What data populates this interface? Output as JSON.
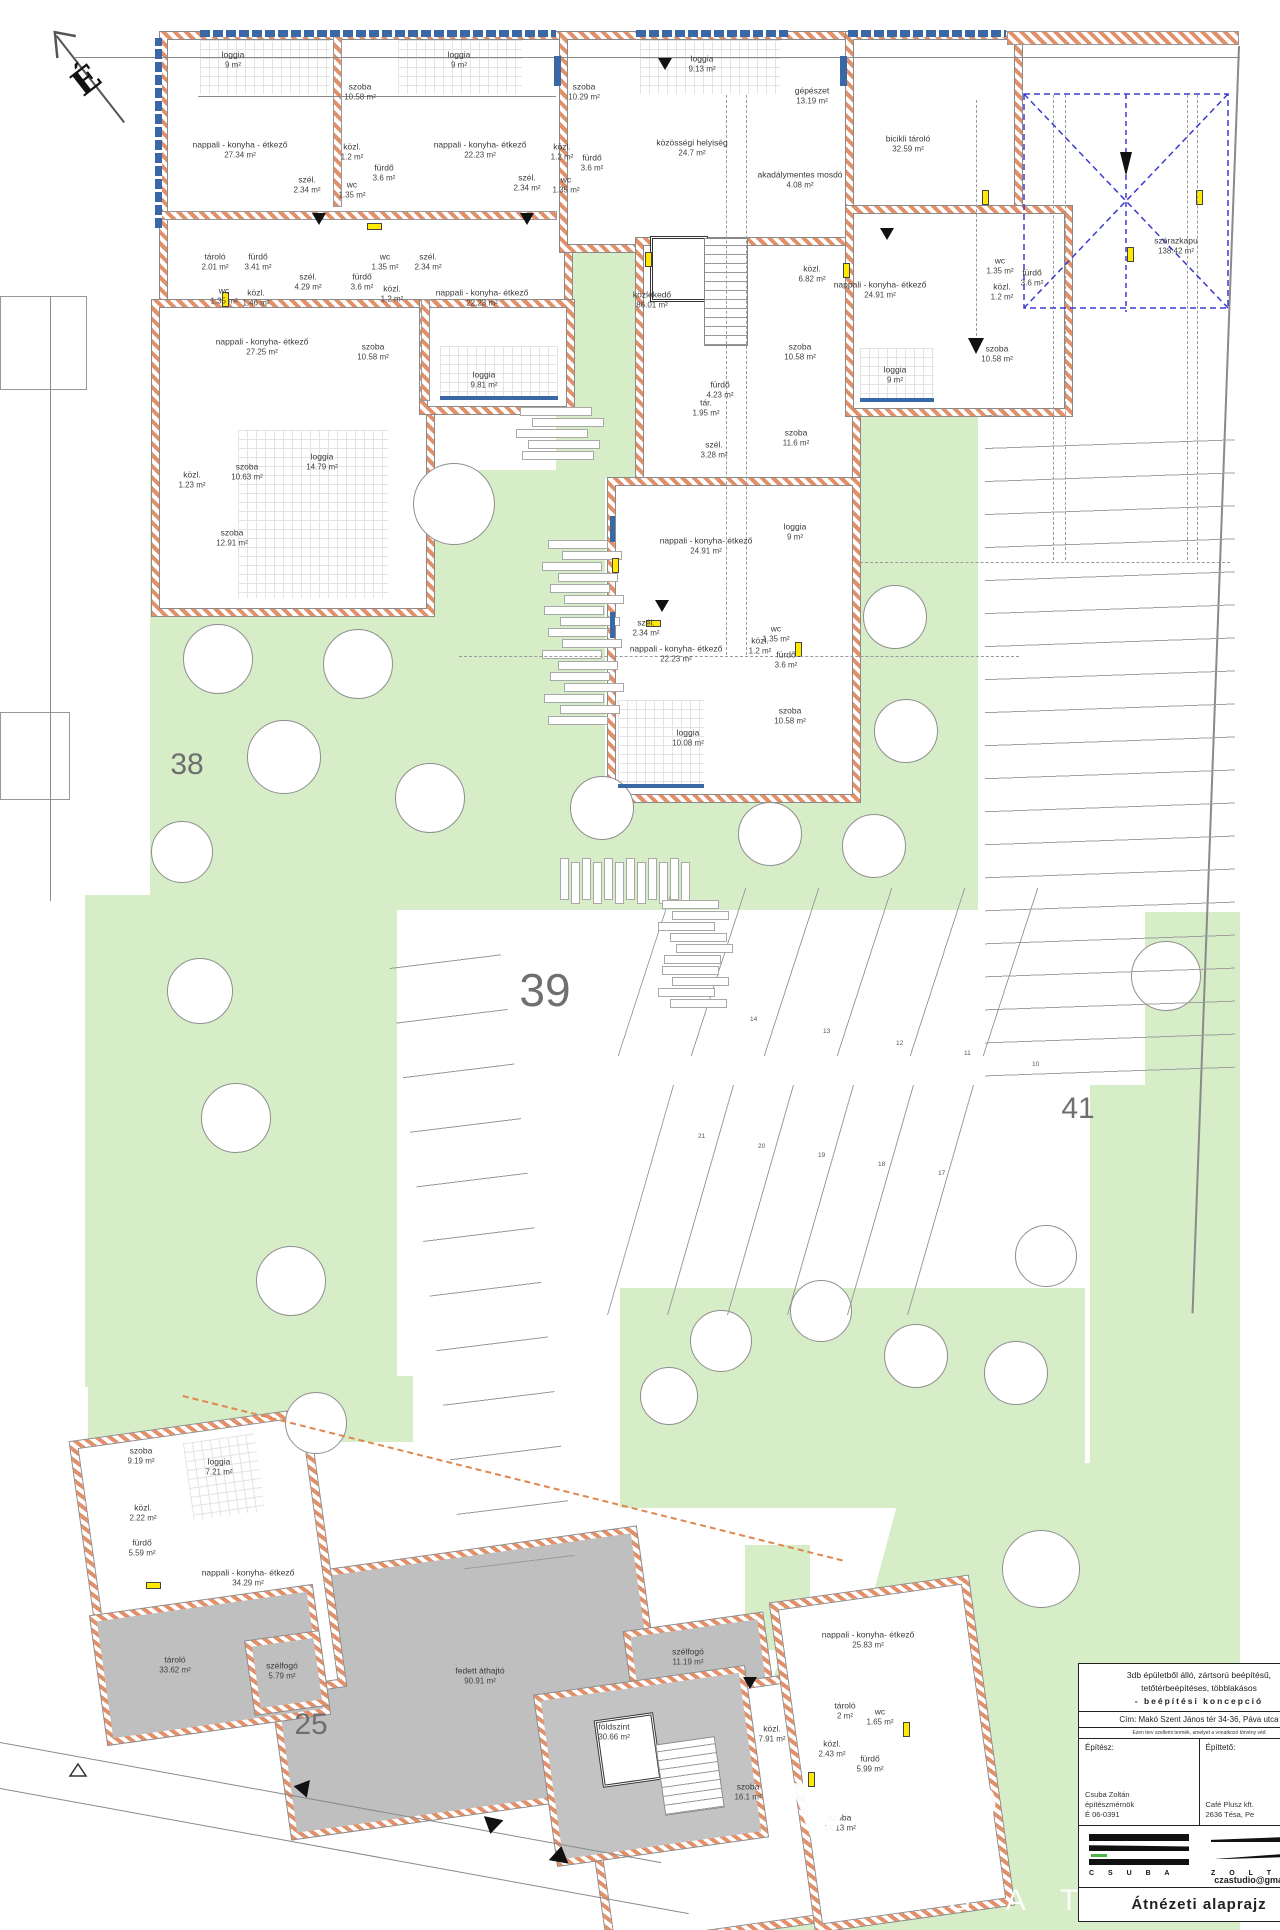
{
  "meta": {
    "compass_letter": "É",
    "sheet_type": "floor plan"
  },
  "watermark": {
    "big": "VÁR",
    "small": "I N G A T"
  },
  "plot_numbers": [
    {
      "t": "38",
      "x": 187,
      "y": 765,
      "s": 30
    },
    {
      "t": "39",
      "x": 545,
      "y": 990,
      "s": 46
    },
    {
      "t": "41",
      "x": 1078,
      "y": 1109,
      "s": 30
    },
    {
      "t": "25",
      "x": 311,
      "y": 1725,
      "s": 30
    }
  ],
  "parking_numbers": [
    {
      "t": "14",
      "x": 750,
      "y": 1016
    },
    {
      "t": "13",
      "x": 823,
      "y": 1028
    },
    {
      "t": "12",
      "x": 896,
      "y": 1040
    },
    {
      "t": "11",
      "x": 964,
      "y": 1050
    },
    {
      "t": "10",
      "x": 1032,
      "y": 1061
    },
    {
      "t": "21",
      "x": 698,
      "y": 1133
    },
    {
      "t": "20",
      "x": 758,
      "y": 1143
    },
    {
      "t": "19",
      "x": 818,
      "y": 1152
    },
    {
      "t": "18",
      "x": 878,
      "y": 1161
    },
    {
      "t": "17",
      "x": 938,
      "y": 1170
    }
  ],
  "rooms": [
    {
      "n": "loggia",
      "a": "9 m²",
      "x": 233,
      "y": 60
    },
    {
      "n": "szoba",
      "a": "10.58 m²",
      "x": 360,
      "y": 92
    },
    {
      "n": "loggia",
      "a": "9 m²",
      "x": 459,
      "y": 60
    },
    {
      "n": "nappali - konyha - étkező",
      "a": "27.34 m²",
      "x": 240,
      "y": 150
    },
    {
      "n": "közl.",
      "a": "1.2 m²",
      "x": 352,
      "y": 152
    },
    {
      "n": "fürdő",
      "a": "3.6 m²",
      "x": 384,
      "y": 173
    },
    {
      "n": "szél.",
      "a": "2.34 m²",
      "x": 307,
      "y": 185
    },
    {
      "n": "wc",
      "a": "1.35 m²",
      "x": 352,
      "y": 190
    },
    {
      "n": "nappali - konyha- étkező",
      "a": "22.23 m²",
      "x": 480,
      "y": 150
    },
    {
      "n": "szél.",
      "a": "2.34 m²",
      "x": 527,
      "y": 183
    },
    {
      "n": "szoba",
      "a": "10.29 m²",
      "x": 584,
      "y": 92
    },
    {
      "n": "közl.",
      "a": "1.2 m²",
      "x": 562,
      "y": 152
    },
    {
      "n": "fürdő",
      "a": "3.6 m²",
      "x": 592,
      "y": 163
    },
    {
      "n": "wc",
      "a": "1.35 m²",
      "x": 566,
      "y": 185
    },
    {
      "n": "tároló",
      "a": "2.01 m²",
      "x": 215,
      "y": 262
    },
    {
      "n": "fürdő",
      "a": "3.41 m²",
      "x": 258,
      "y": 262
    },
    {
      "n": "szél.",
      "a": "4.29 m²",
      "x": 308,
      "y": 282
    },
    {
      "n": "wc",
      "a": "1.35 m²",
      "x": 224,
      "y": 296
    },
    {
      "n": "közl.",
      "a": "1.46 m²",
      "x": 256,
      "y": 298
    },
    {
      "n": "nappali - konyha- étkező",
      "a": "27.25 m²",
      "x": 262,
      "y": 347
    },
    {
      "n": "fürdő",
      "a": "3.6 m²",
      "x": 362,
      "y": 282
    },
    {
      "n": "wc",
      "a": "1.35 m²",
      "x": 385,
      "y": 262
    },
    {
      "n": "közl.",
      "a": "1.2 m²",
      "x": 392,
      "y": 294
    },
    {
      "n": "szél.",
      "a": "2.34 m²",
      "x": 428,
      "y": 262
    },
    {
      "n": "szoba",
      "a": "10.58 m²",
      "x": 373,
      "y": 352
    },
    {
      "n": "nappali - konyha- étkező",
      "a": "22.23 m²",
      "x": 482,
      "y": 298
    },
    {
      "n": "loggia",
      "a": "9.81 m²",
      "x": 484,
      "y": 380
    },
    {
      "n": "szoba",
      "a": "10.63 m²",
      "x": 247,
      "y": 472
    },
    {
      "n": "közl.",
      "a": "1.23 m²",
      "x": 192,
      "y": 480
    },
    {
      "n": "loggia",
      "a": "14.79 m²",
      "x": 322,
      "y": 462
    },
    {
      "n": "szoba",
      "a": "12.91 m²",
      "x": 232,
      "y": 538
    },
    {
      "n": "loggia",
      "a": "9.13 m²",
      "x": 702,
      "y": 64
    },
    {
      "n": "közösségi helyiség",
      "a": "24.7 m²",
      "x": 692,
      "y": 148
    },
    {
      "n": "gépészet",
      "a": "13.19 m²",
      "x": 812,
      "y": 96
    },
    {
      "n": "akadálymentes mosdó",
      "a": "4.08 m²",
      "x": 800,
      "y": 180
    },
    {
      "n": "közlekedő",
      "a": "86.01 m²",
      "x": 652,
      "y": 300
    },
    {
      "n": "közl.",
      "a": "6.82 m²",
      "x": 812,
      "y": 274
    },
    {
      "n": "fürdő",
      "a": "4.23 m²",
      "x": 720,
      "y": 390
    },
    {
      "n": "tár.",
      "a": "1.95 m²",
      "x": 706,
      "y": 408
    },
    {
      "n": "szél.",
      "a": "3.28 m²",
      "x": 714,
      "y": 450
    },
    {
      "n": "szoba",
      "a": "11.6 m²",
      "x": 796,
      "y": 438
    },
    {
      "n": "szoba",
      "a": "10.58 m²",
      "x": 800,
      "y": 352
    },
    {
      "n": "nappali - konyha- étkező",
      "a": "24.91 m²",
      "x": 880,
      "y": 290
    },
    {
      "n": "loggia",
      "a": "9 m²",
      "x": 895,
      "y": 375
    },
    {
      "n": "nappali - konyha- étkező",
      "a": "24.91 m²",
      "x": 706,
      "y": 546
    },
    {
      "n": "loggia",
      "a": "9 m²",
      "x": 795,
      "y": 532
    },
    {
      "n": "szél.",
      "a": "2.34 m²",
      "x": 646,
      "y": 628
    },
    {
      "n": "nappali - konyha- étkező",
      "a": "22.23 m²",
      "x": 676,
      "y": 654
    },
    {
      "n": "wc",
      "a": "1.35 m²",
      "x": 776,
      "y": 634
    },
    {
      "n": "közl.",
      "a": "1.2 m²",
      "x": 760,
      "y": 646
    },
    {
      "n": "fürdő",
      "a": "3.6 m²",
      "x": 786,
      "y": 660
    },
    {
      "n": "szoba",
      "a": "10.58 m²",
      "x": 790,
      "y": 716
    },
    {
      "n": "loggia",
      "a": "10.08 m²",
      "x": 688,
      "y": 738
    },
    {
      "n": "bicikli tároló",
      "a": "32.59 m²",
      "x": 908,
      "y": 144
    },
    {
      "n": "szárazkapu",
      "a": "138.42 m²",
      "x": 1176,
      "y": 246
    },
    {
      "n": "wc",
      "a": "1.35 m²",
      "x": 1000,
      "y": 266
    },
    {
      "n": "fürdő",
      "a": "3.6 m²",
      "x": 1032,
      "y": 278
    },
    {
      "n": "közl.",
      "a": "1.2 m²",
      "x": 1002,
      "y": 292
    },
    {
      "n": "szoba",
      "a": "10.58 m²",
      "x": 997,
      "y": 354
    },
    {
      "n": "szoba",
      "a": "9.19 m²",
      "x": 141,
      "y": 1456
    },
    {
      "n": "loggia",
      "a": "7.21 m²",
      "x": 219,
      "y": 1467
    },
    {
      "n": "közl.",
      "a": "2.22 m²",
      "x": 143,
      "y": 1513
    },
    {
      "n": "fürdő",
      "a": "5.59 m²",
      "x": 142,
      "y": 1548
    },
    {
      "n": "nappali - konyha- étkező",
      "a": "34.29 m²",
      "x": 248,
      "y": 1578
    },
    {
      "n": "tároló",
      "a": "33.62 m²",
      "x": 175,
      "y": 1665
    },
    {
      "n": "szélfogó",
      "a": "5.79 m²",
      "x": 282,
      "y": 1671
    },
    {
      "n": "fedett áthajtó",
      "a": "90.91 m²",
      "x": 480,
      "y": 1676
    },
    {
      "n": "szélfogó",
      "a": "11.19 m²",
      "x": 688,
      "y": 1657
    },
    {
      "n": "földszint",
      "a": "30.66 m²",
      "x": 614,
      "y": 1732
    },
    {
      "n": "közl.",
      "a": "7.91 m²",
      "x": 772,
      "y": 1734
    },
    {
      "n": "szoba",
      "a": "16.1 m²",
      "x": 748,
      "y": 1792
    },
    {
      "n": "nappali - konyha- étkező",
      "a": "25.83 m²",
      "x": 868,
      "y": 1640
    },
    {
      "n": "tároló",
      "a": "2 m²",
      "x": 845,
      "y": 1711
    },
    {
      "n": "wc",
      "a": "1.65 m²",
      "x": 880,
      "y": 1717
    },
    {
      "n": "közl.",
      "a": "2.43 m²",
      "x": 832,
      "y": 1749
    },
    {
      "n": "fürdő",
      "a": "5.99 m²",
      "x": 870,
      "y": 1764
    },
    {
      "n": "szoba",
      "a": "14.13 m²",
      "x": 840,
      "y": 1823
    }
  ],
  "trees": [
    {
      "x": 453,
      "y": 503,
      "r": 40
    },
    {
      "x": 217,
      "y": 658,
      "r": 34
    },
    {
      "x": 357,
      "y": 663,
      "r": 34
    },
    {
      "x": 283,
      "y": 756,
      "r": 36
    },
    {
      "x": 429,
      "y": 797,
      "r": 34
    },
    {
      "x": 601,
      "y": 807,
      "r": 31
    },
    {
      "x": 769,
      "y": 833,
      "r": 31
    },
    {
      "x": 873,
      "y": 845,
      "r": 31
    },
    {
      "x": 894,
      "y": 616,
      "r": 31
    },
    {
      "x": 905,
      "y": 730,
      "r": 31
    },
    {
      "x": 181,
      "y": 851,
      "r": 30
    },
    {
      "x": 199,
      "y": 990,
      "r": 32
    },
    {
      "x": 235,
      "y": 1117,
      "r": 34
    },
    {
      "x": 290,
      "y": 1280,
      "r": 34
    },
    {
      "x": 1165,
      "y": 975,
      "r": 34
    },
    {
      "x": 720,
      "y": 1340,
      "r": 30
    },
    {
      "x": 820,
      "y": 1310,
      "r": 30
    },
    {
      "x": 915,
      "y": 1355,
      "r": 31
    },
    {
      "x": 1015,
      "y": 1372,
      "r": 31
    },
    {
      "x": 1045,
      "y": 1255,
      "r": 30
    },
    {
      "x": 668,
      "y": 1395,
      "r": 28
    },
    {
      "x": 315,
      "y": 1422,
      "r": 30
    },
    {
      "x": 1040,
      "y": 1568,
      "r": 38
    }
  ],
  "title_block": {
    "desc_line1": "3db épületből álló, zártsorú beépítésű,",
    "desc_line2": "tetőtérbeépítéses, többlakásos",
    "desc_line3": "- beépítési koncepció",
    "address": "Cím: Makó Szent János tér 34-36, Páva utca",
    "legal": "Ezen terv szellemi termék, amelyet a vonatkozó törvény véd",
    "architect_label": "Építész:",
    "client_label": "Építtető:",
    "architect_name": "Csuba Zoltán",
    "architect_title": "építészmérnök",
    "architect_reg": "É 06-0391",
    "client_name": "Café Plusz kft.",
    "client_address": "2636 Tésa, Pe",
    "logo_letters_left": "C S U B A",
    "logo_letters_right": "Z O L T Á N",
    "email": "czastudio@gmail.com",
    "sheet_title": "Átnézeti alaprajz"
  }
}
